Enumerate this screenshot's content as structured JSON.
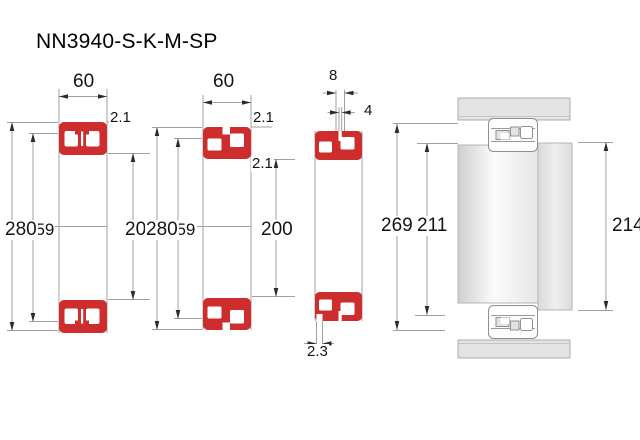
{
  "title": "NN3940-S-K-M-SP",
  "colors": {
    "bearing_red": "#cd2d2d",
    "dim_line": "#a0a0a0",
    "arrow": "#2b2b2b",
    "housing_gray": "#e4e4e4",
    "shaft_gray": "#ececec"
  },
  "views": {
    "v1": {
      "description": "cross-section-cylindrical-bore",
      "width": "60",
      "chamfer": "2.1",
      "outer_diameter": "280",
      "raceway_diameter": "259",
      "bore_diameter": "200"
    },
    "v2": {
      "description": "cross-section-tapered-bore",
      "width": "60",
      "chamfer_outer": "2.1",
      "chamfer_inner": "2.1",
      "outer_diameter": "280",
      "raceway_diameter": "259",
      "bore_diameter": "200"
    },
    "v3": {
      "description": "cross-section-lubrication-features",
      "groove_width": "8",
      "hole_diameter": "4",
      "housing_abutment_diameter": "269",
      "shaft_abutment_diameter": "211",
      "slot_width": "2.3"
    },
    "v4": {
      "description": "mounted-arrangement",
      "shoulder_diameter": "214"
    }
  }
}
